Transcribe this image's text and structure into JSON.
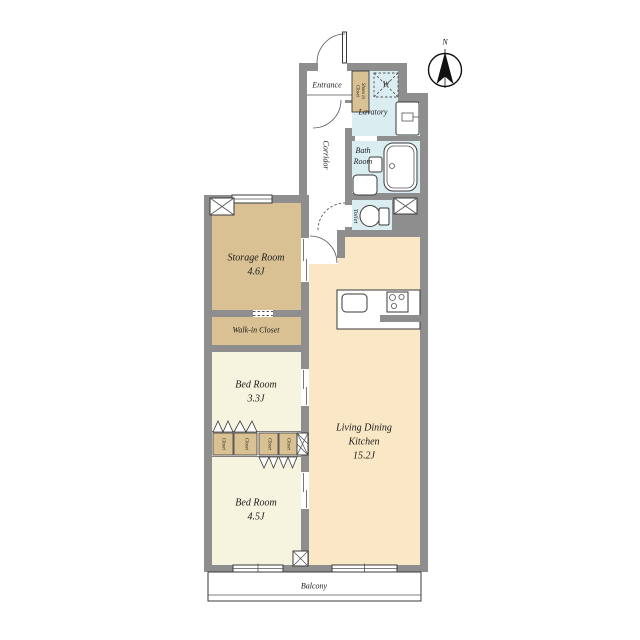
{
  "palette": {
    "wall_gray": "#8e8e8e",
    "storage_tan": "#d9c193",
    "bedroom_cream": "#f6f4df",
    "ldk_beige": "#f9e7c5",
    "wet_area_blue": "#daeef2",
    "line_black": "#3a3a3a",
    "background": "#ffffff"
  },
  "compass": {
    "north_label": "N"
  },
  "rooms": {
    "entrance": {
      "name": "Entrance"
    },
    "shoes_in_closet": {
      "line1": "Shoes in",
      "line2": "Closet"
    },
    "washer": {
      "symbol": "W"
    },
    "lavatory": {
      "name": "Lavatory"
    },
    "bath": {
      "line1": "Bath",
      "line2": "Room"
    },
    "corridor": {
      "name": "Corridor"
    },
    "toilet": {
      "name": "Toilet"
    },
    "storage": {
      "name": "Storage Room",
      "size": "4.6J"
    },
    "walk_in_closet": {
      "name": "Walk-in Closet"
    },
    "bedroom_33": {
      "name": "Bed Room",
      "size": "3.3J"
    },
    "bedroom_45": {
      "name": "Bed Room",
      "size": "4.5J"
    },
    "ldk": {
      "line1": "Living Dining",
      "line2": "Kitchen",
      "size": "15.2J"
    },
    "balcony": {
      "name": "Balcony"
    },
    "closets": [
      {
        "name": "Closet"
      },
      {
        "name": "Closet"
      },
      {
        "name": "Closet"
      },
      {
        "name": "Closet"
      }
    ]
  }
}
